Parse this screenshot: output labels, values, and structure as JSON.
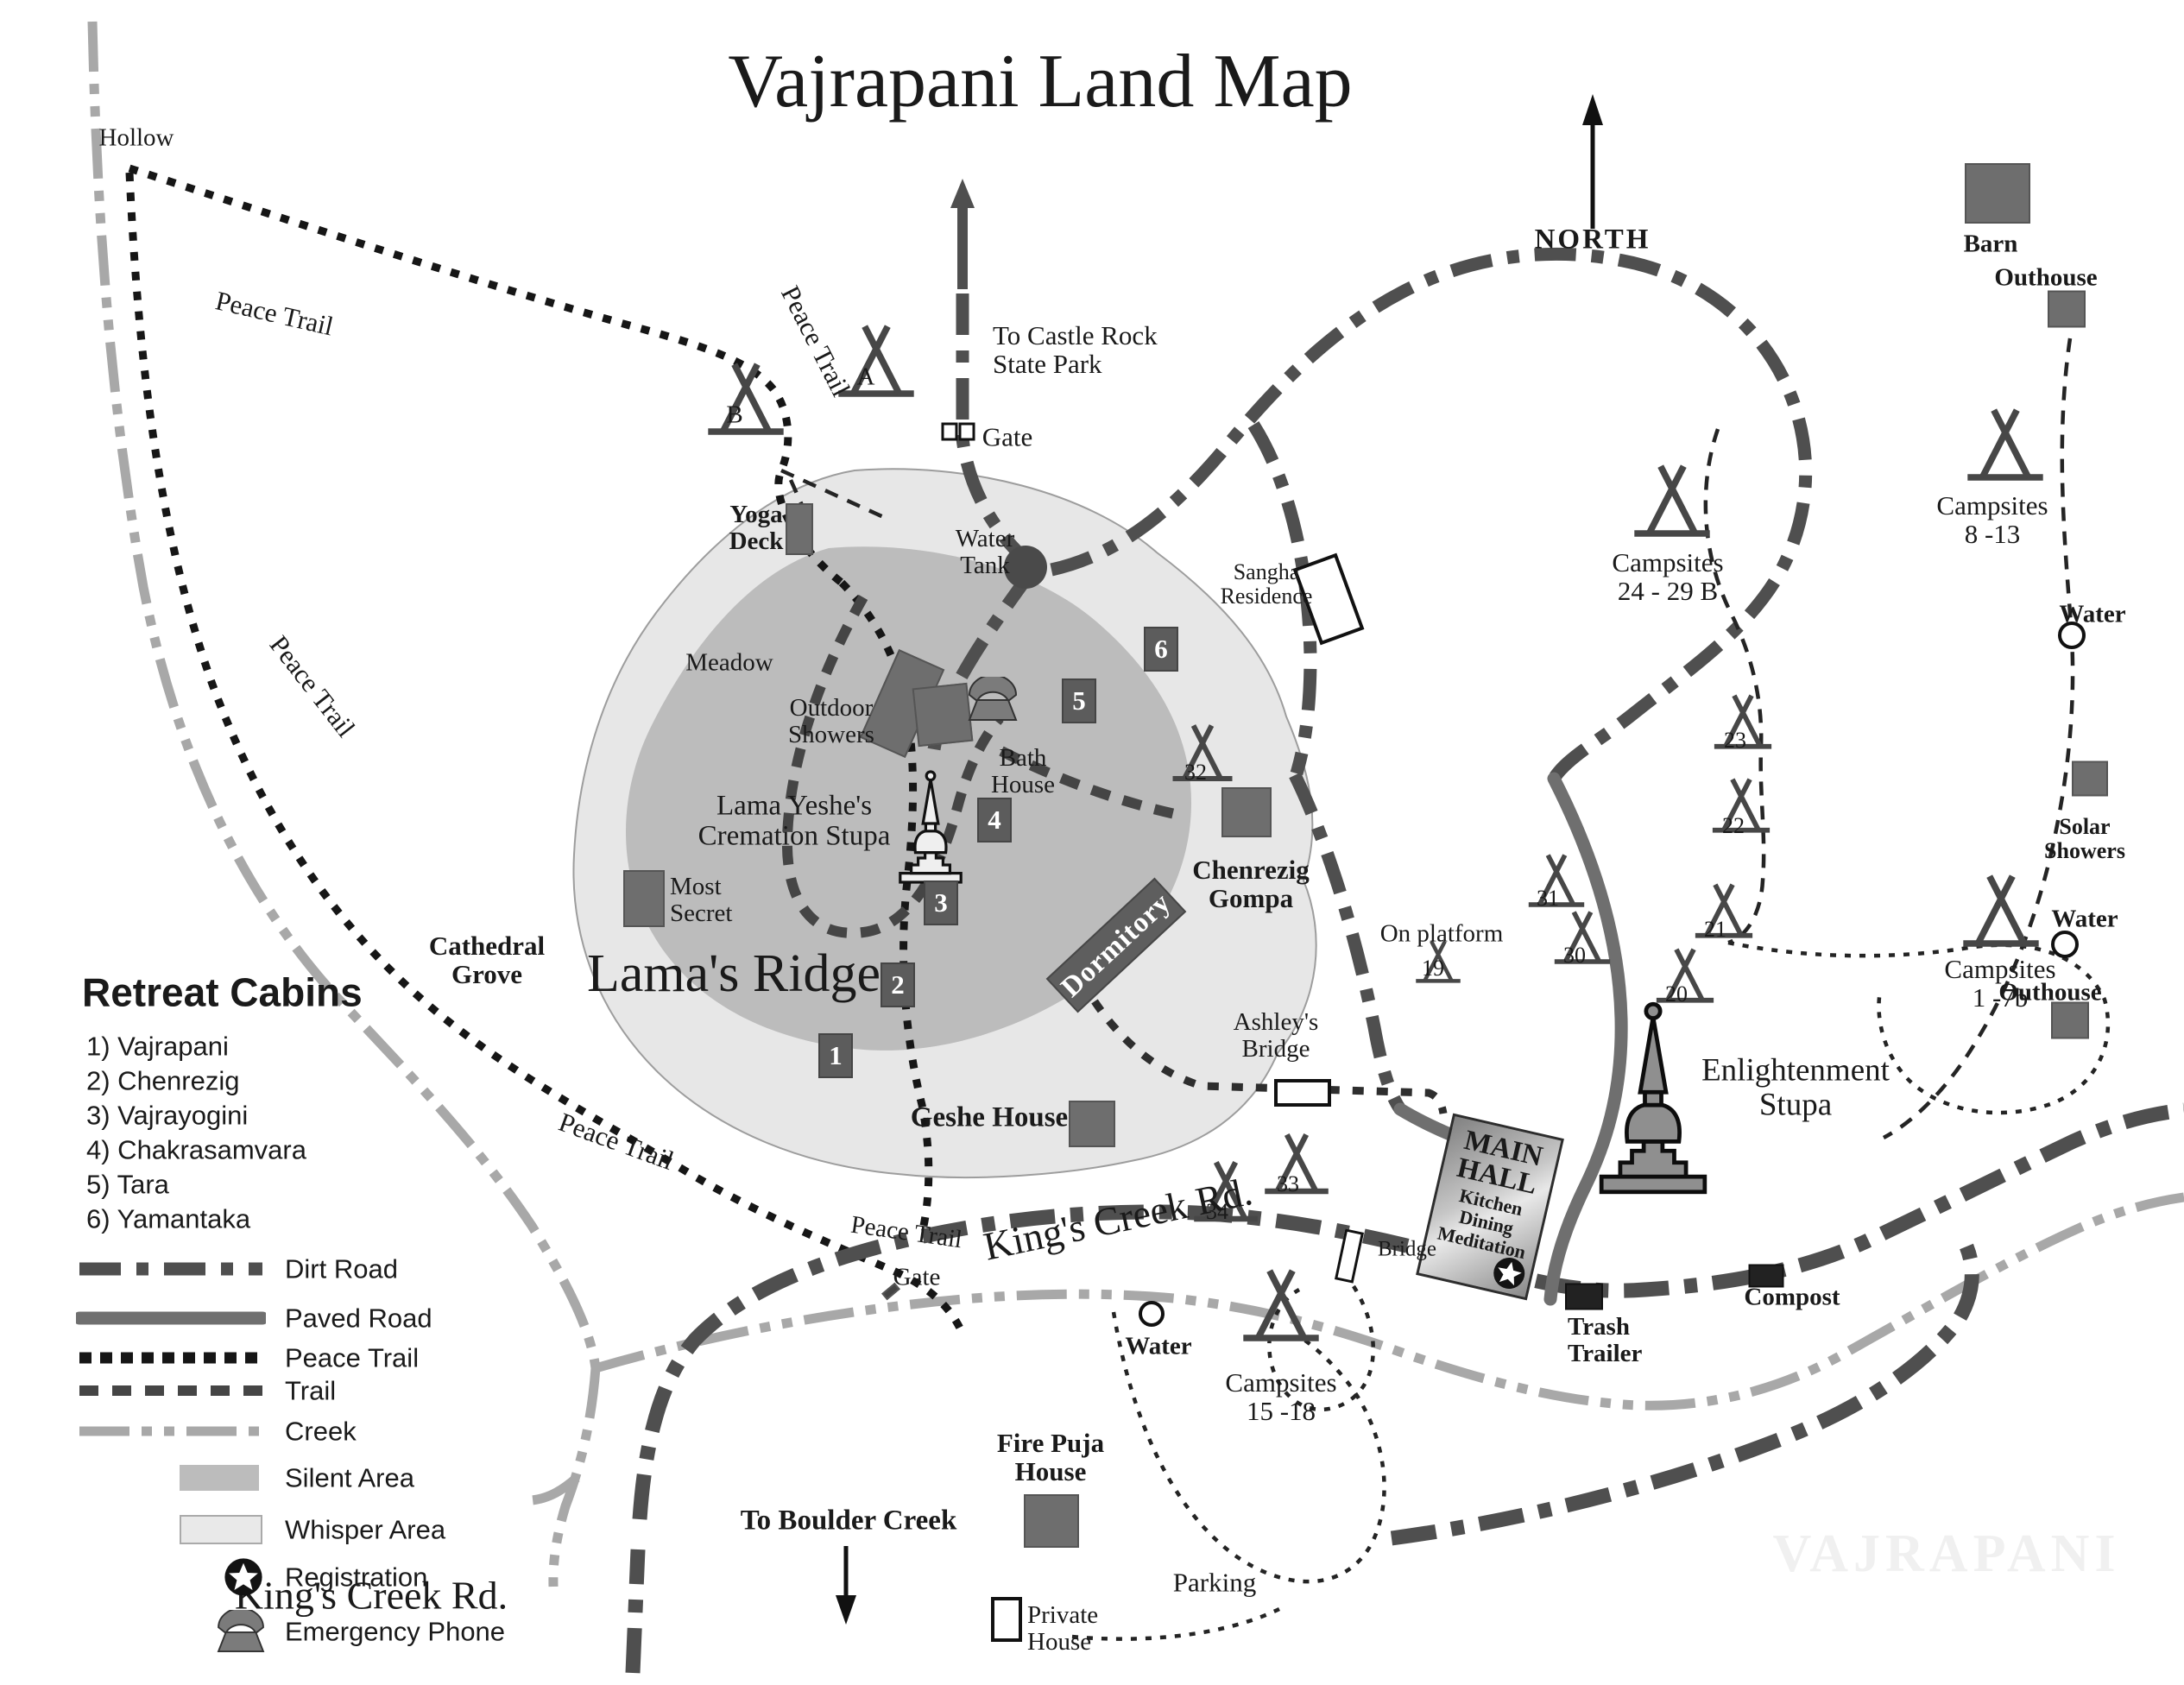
{
  "title": "Vajrapani Land Map",
  "compass": {
    "north": "NORTH"
  },
  "labels": {
    "hollow": "Hollow",
    "peace_trail": "Peace Trail",
    "to_castle_rock": "To Castle Rock\nState Park",
    "gate": "Gate",
    "yoga_deck": "Yoga\nDeck",
    "water_tank": "Water\nTank",
    "meadow": "Meadow",
    "outdoor_showers": "Outdoor\nShowers",
    "bath_house": "Bath\nHouse",
    "cremation_stupa": "Lama Yeshe's\nCremation Stupa",
    "most_secret": "Most\nSecret",
    "lamas_ridge": "Lama's Ridge",
    "cathedral_grove": "Cathedral\nGrove",
    "geshe_house": "Geshe House",
    "chenrezig_gompa": "Chenrezig\nGompa",
    "dormitory": "Dormitory",
    "sangha_residence": "Sangha\nResidence",
    "on_platform": "On platform",
    "ashleys_bridge": "Ashley's\nBridge",
    "enlightenment_stupa": "Enlightenment\nStupa",
    "main_hall": "MAIN\nHALL",
    "main_hall_sub": "Kitchen\nDining\nMeditation",
    "kings_creek_rd": "King's Creek Rd.",
    "to_boulder_creek": "To Boulder Creek",
    "fire_puja_house": "Fire Puja\nHouse",
    "private_house": "Private\nHouse",
    "parking": "Parking",
    "water": "Water",
    "bridge": "Bridge",
    "trash_trailer": "Trash\nTrailer",
    "compost": "Compost",
    "barn": "Barn",
    "outhouse": "Outhouse",
    "solar_showers": "Solar\nShowers",
    "campsites_8_13": "Campsites\n8 -13",
    "campsites_24_29b": "Campsites\n24 - 29 B",
    "campsites_1_7b": "Campsites\n1 -7b",
    "campsites_15_18": "Campsites\n15 -18",
    "watermark": "VAJRAPANI"
  },
  "cabin_numbers": {
    "c1": "1",
    "c2": "2",
    "c3": "3",
    "c4": "4",
    "c5": "5",
    "c6": "6"
  },
  "tent_labels": {
    "a": "A",
    "b": "B",
    "t19": "19",
    "t20": "20",
    "t21": "21",
    "t22": "22",
    "t23": "23",
    "t30": "30",
    "t31": "31",
    "t32": "32",
    "t33": "33",
    "t34": "34"
  },
  "legend": {
    "cabins_title": "Retreat Cabins",
    "cabins": [
      "1) Vajrapani",
      "2) Chenrezig",
      "3) Vajrayogini",
      "4) Chakrasamvara",
      "5) Tara",
      "6) Yamantaka"
    ],
    "dirt_road": "Dirt Road",
    "paved_road": "Paved Road",
    "peace_trail": "Peace Trail",
    "trail": "Trail",
    "creek": "Creek",
    "silent_area": "Silent Area",
    "whisper_area": "Whisper Area",
    "registration": "Registration",
    "emergency_phone": "Emergency Phone"
  },
  "colors": {
    "silent_area": "#bcbcbc",
    "whisper_area": "#e7e7e7",
    "dirt_road": "#4f4f4f",
    "paved_road": "#6f6f6f",
    "creek": "#a8a8a8",
    "peace_trail": "#161616",
    "building": "#6e6e6e"
  }
}
